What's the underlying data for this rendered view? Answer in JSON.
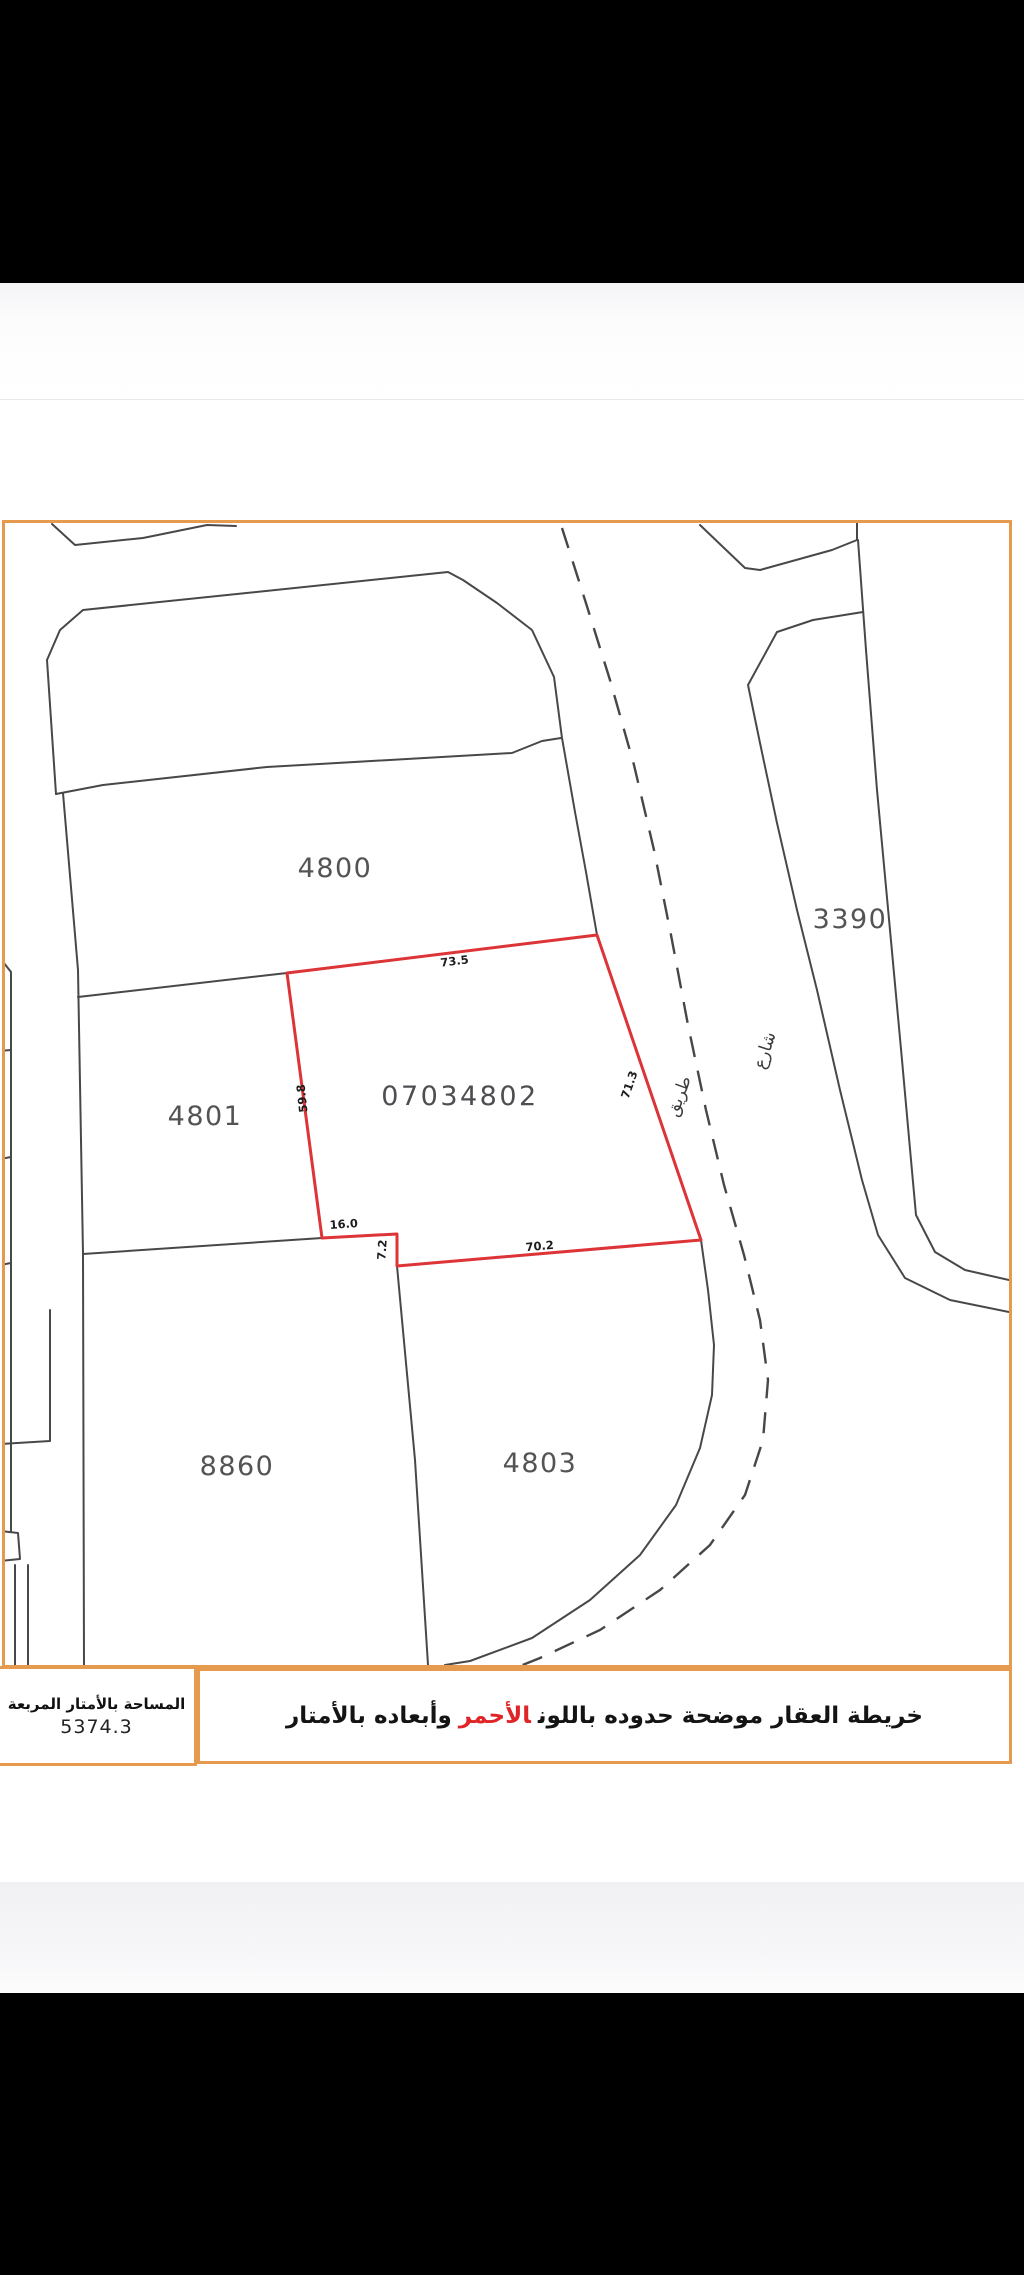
{
  "colors": {
    "frame_orange": "#e59a4e",
    "highlight_red": "#dd3438",
    "parcel_line": "#48484b",
    "caption_red": "#e02529"
  },
  "parcels": {
    "p4800": "4800",
    "p4801": "4801",
    "p8860": "8860",
    "p4803": "4803",
    "p3390": "3390",
    "highlight_id": "07034802"
  },
  "dimensions": {
    "top": "73.5",
    "left": "59.8",
    "right": "71.3",
    "bottom": "70.2",
    "step": "7.2",
    "notch": "16.0"
  },
  "roads": {
    "label_tariq": "طريق",
    "label_sharee": "شارع"
  },
  "title_block": {
    "area_label": "المساحة بالأمتار المربعة",
    "area_value": "5374.3",
    "caption_before_red": "خريطة العقار موضحة حدوده باللون",
    "caption_red_word": "الأحمر",
    "caption_after_red": "وأبعاده بالأمتار"
  }
}
